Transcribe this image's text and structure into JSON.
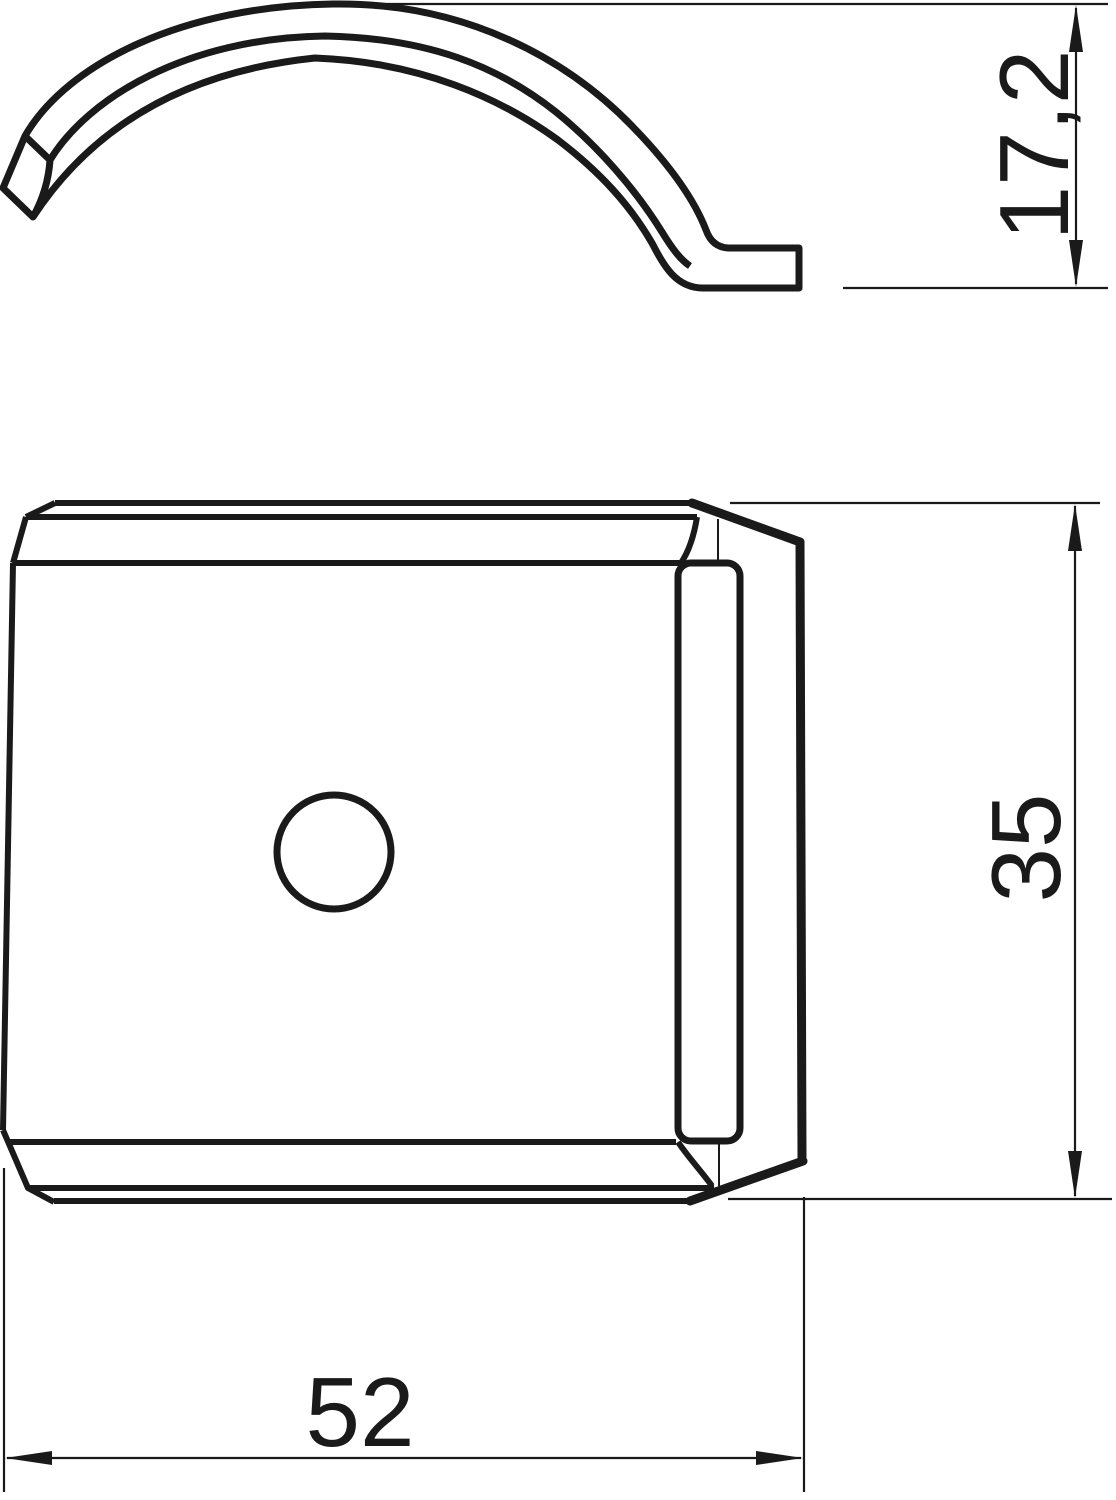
{
  "drawing": {
    "kind": "technical-drawing",
    "units_style": "comma-decimal",
    "colors": {
      "line": "#1a1a1a",
      "background": "#ffffff"
    },
    "views": {
      "side_view_label": "clip-side-profile",
      "front_view_label": "clamp-front-view"
    },
    "dimensions": {
      "side_height": "17,2",
      "front_height": "35",
      "front_width": "52"
    }
  }
}
